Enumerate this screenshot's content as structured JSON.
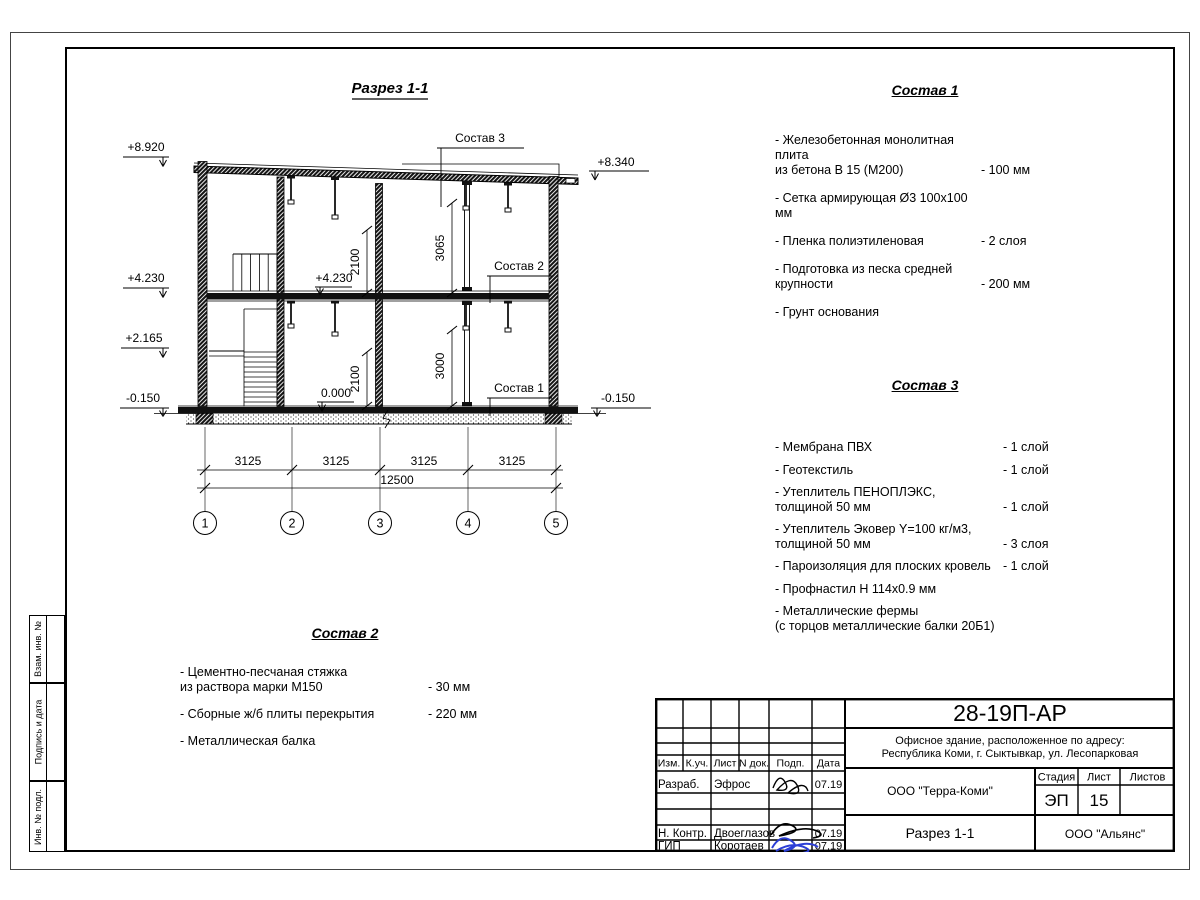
{
  "drawing": {
    "title": "Разрез 1-1",
    "grid_labels": [
      "1",
      "2",
      "3",
      "4",
      "5"
    ],
    "elev_left": [
      "+8.920",
      "+4.230",
      "+2.165",
      "-0.150"
    ],
    "elev_right_top": "+8.340",
    "elev_right_bottom": "-0.150",
    "interior_elev": [
      "+4.230",
      "0.000"
    ],
    "callout_sostav3": "Состав 3",
    "callout_sostav2": "Состав 2",
    "callout_sostav1": "Состав 1",
    "dim_bays": [
      "3125",
      "3125",
      "3125",
      "3125"
    ],
    "dim_total": "12500",
    "dim_v": [
      "2100",
      "3065",
      "2100",
      "3000"
    ]
  },
  "sostav1": {
    "title": "Состав 1",
    "items": [
      {
        "label": "- Железобетонная  монолитная плита\nиз бетона В 15 (М200)",
        "value": "- 100 мм"
      },
      {
        "label": "- Сетка армирующая Ø3 100х100 мм",
        "value": ""
      },
      {
        "label": "- Пленка полиэтиленовая",
        "value": "-  2 слоя"
      },
      {
        "label": "- Подготовка из песка средней\nкрупности",
        "value": "- 200 мм"
      },
      {
        "label": "- Грунт основания",
        "value": ""
      }
    ]
  },
  "sostav2": {
    "title": "Состав 2",
    "items": [
      {
        "label": "- Цементно-песчаная стяжка\nиз раствора марки М150",
        "value": "- 30 мм"
      },
      {
        "label": "- Сборные ж/б плиты перекрытия",
        "value": "- 220 мм"
      },
      {
        "label": "- Металлическая балка",
        "value": ""
      }
    ]
  },
  "sostav3": {
    "title": "Состав 3",
    "items": [
      {
        "label": "- Мембрана ПВХ",
        "value": "- 1 слой"
      },
      {
        "label": "- Геотекстиль",
        "value": "- 1 слой"
      },
      {
        "label": "- Утеплитель ПЕНОПЛЭКС,\nтолщиной 50 мм",
        "value": "- 1 слой"
      },
      {
        "label": "- Утеплитель Эковер Y=100 кг/м3,\nтолщиной 50 мм",
        "value": "- 3 слоя"
      },
      {
        "label": "- Пароизоляция для плоских кровель",
        "value": "- 1 слой"
      },
      {
        "label": "- Профнастил Н 114х0.9 мм",
        "value": ""
      },
      {
        "label": "- Металлические фермы\n(с торцов металлические балки 20Б1)",
        "value": ""
      }
    ]
  },
  "titleblock": {
    "doc_number": "28-19П-АР",
    "desc_line1": "Офисное здание, расположенное по адресу:",
    "desc_line2": "Республика Коми, г. Сыктывкар, ул. Лесопарковая",
    "org": "ООО \"Терра-Коми\"",
    "stage_label": "Стадия",
    "sheet_label": "Лист",
    "sheets_label": "Листов",
    "stage": "ЭП",
    "sheet": "15",
    "drawing_name": "Разрез 1-1",
    "org2": "ООО \"Альянс\"",
    "cols": [
      "Изм.",
      "К.уч.",
      "Лист",
      "N док.",
      "Подп.",
      "Дата"
    ],
    "rows": [
      {
        "role": "Разраб.",
        "name": "Эфрос",
        "date": "07.19"
      },
      {
        "role": "Н. Контр.",
        "name": "Двоеглазов",
        "date": "07.19"
      },
      {
        "role": "ГИП",
        "name": "Коротаев",
        "date": "07.19"
      }
    ]
  },
  "side_labels": {
    "box1": "Взам. инв. №",
    "box2": "Подпись и дата",
    "box3": "Инв. № подл."
  }
}
